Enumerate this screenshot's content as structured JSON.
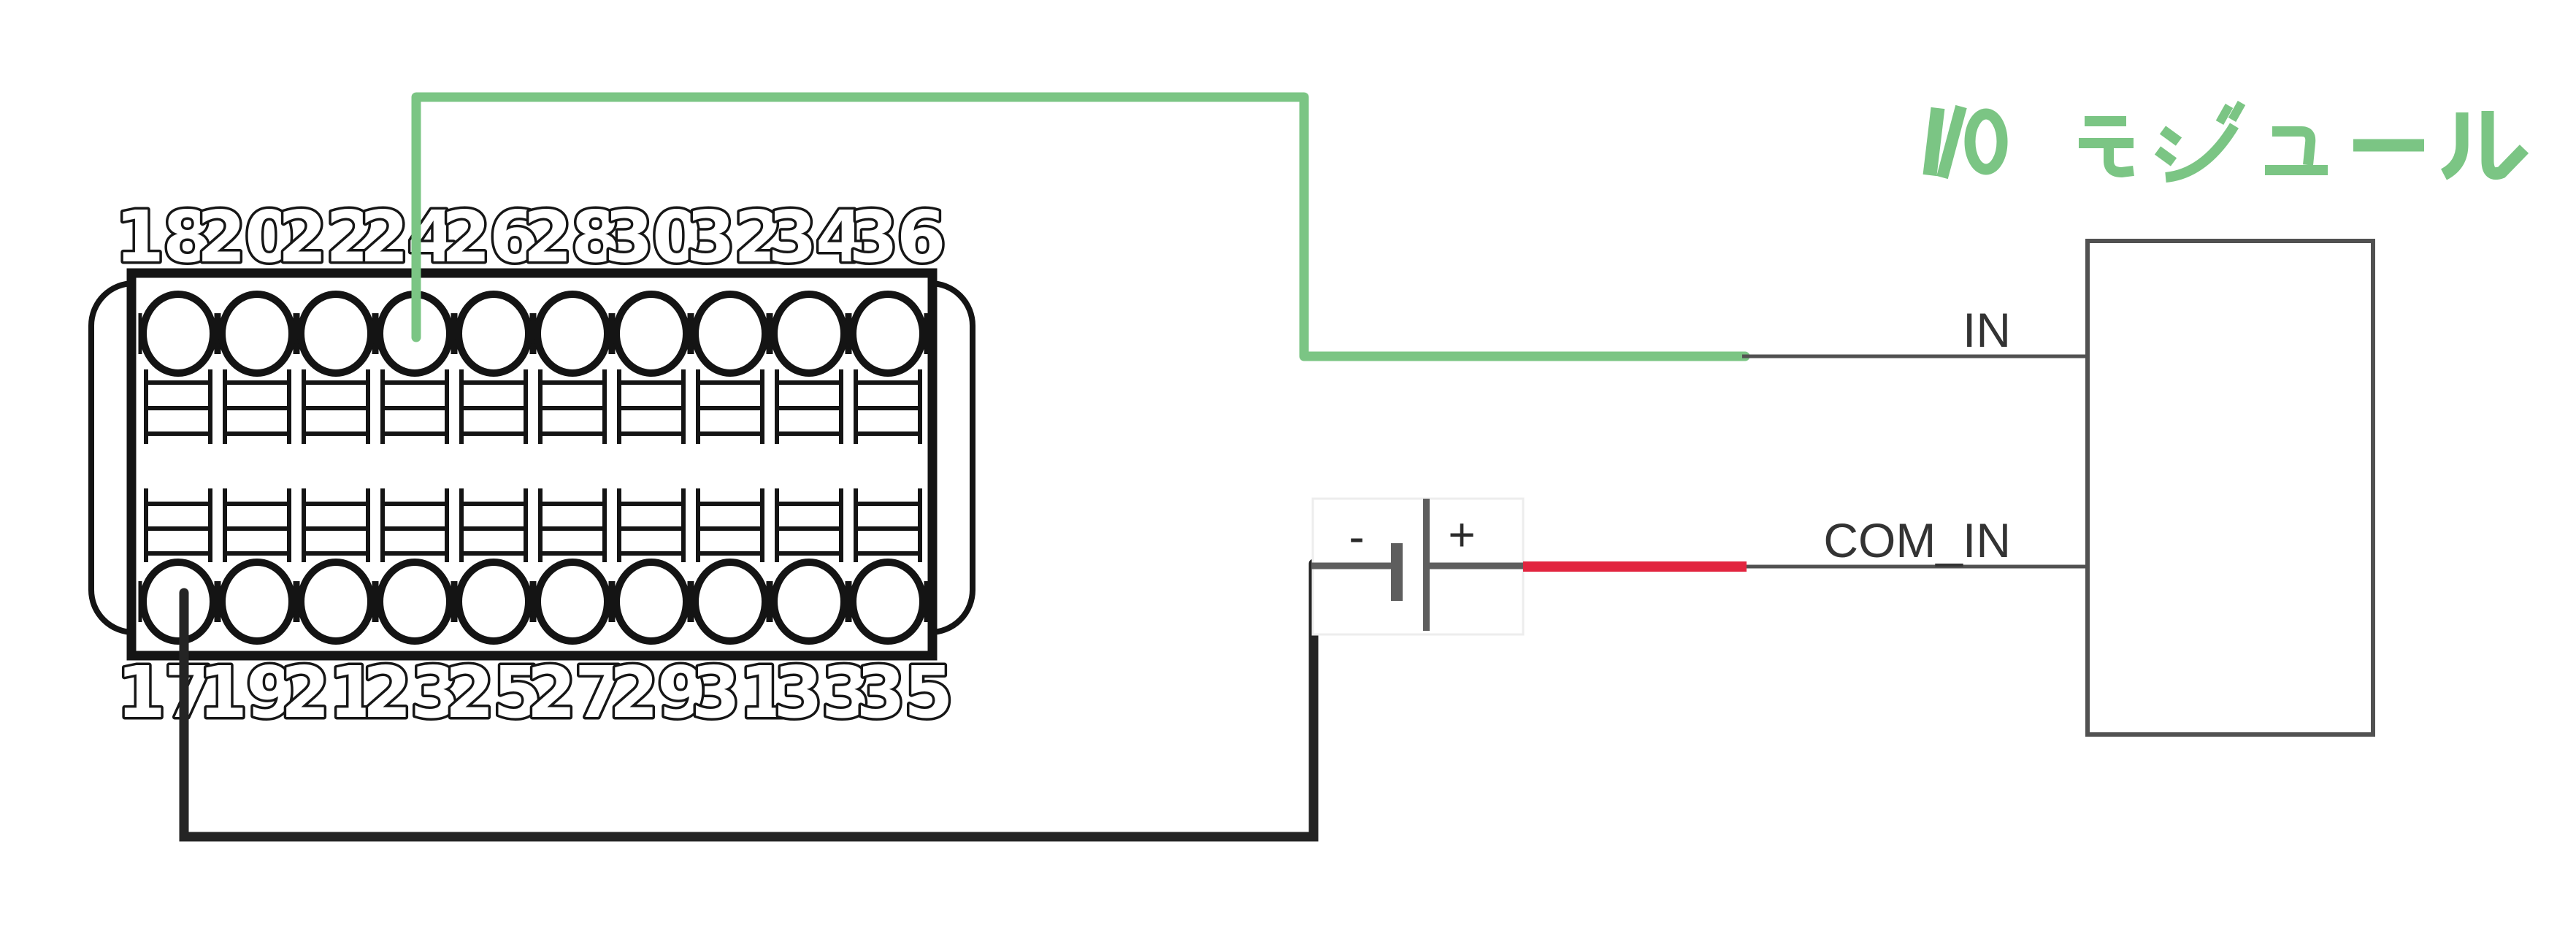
{
  "title": {
    "text": "I/Oモジュール",
    "color": "#7bc584"
  },
  "terminal_block": {
    "top_pins": [
      "18",
      "20",
      "22",
      "24",
      "26",
      "28",
      "30",
      "32",
      "34",
      "36"
    ],
    "bottom_pins": [
      "17",
      "19",
      "21",
      "23",
      "25",
      "27",
      "29",
      "31",
      "33",
      "35"
    ]
  },
  "battery": {
    "negative_label": "-",
    "positive_label": "+"
  },
  "io_module": {
    "input_label": "IN",
    "common_label": "COM_IN"
  },
  "wiring": {
    "input_pin": "24",
    "common_pin": "17",
    "input_wire_color": "#7bc584",
    "common_wire_color": "#e2243f",
    "battery_wire_color": "#242424",
    "line_color": "#515151"
  }
}
